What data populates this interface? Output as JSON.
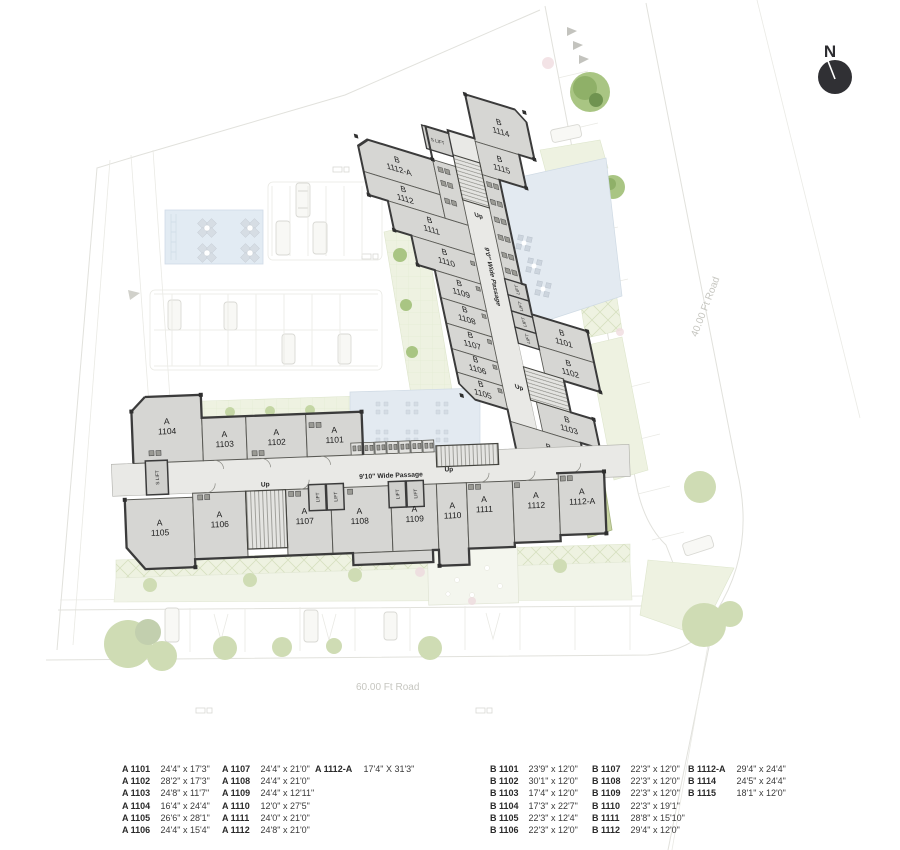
{
  "compass": {
    "label": "N"
  },
  "roads": {
    "bottom": "60.00 Ft Road",
    "right": "40.00 Ft Road"
  },
  "plan": {
    "passage_a": "9'10\" Wide Passage",
    "passage_b": "9'0\" Wide Passage",
    "up": "Up",
    "lift": "LIFT",
    "s_lift": "S LIFT",
    "a_units": [
      {
        "block": "A",
        "num": "1104"
      },
      {
        "block": "A",
        "num": "1103"
      },
      {
        "block": "A",
        "num": "1102"
      },
      {
        "block": "A",
        "num": "1101"
      },
      {
        "block": "A",
        "num": "1105"
      },
      {
        "block": "A",
        "num": "1106"
      },
      {
        "block": "A",
        "num": "1107"
      },
      {
        "block": "A",
        "num": "1108"
      },
      {
        "block": "A",
        "num": "1109"
      },
      {
        "block": "A",
        "num": "1110"
      },
      {
        "block": "A",
        "num": "1111"
      },
      {
        "block": "A",
        "num": "1112"
      },
      {
        "block": "A",
        "num": "1112-A"
      }
    ],
    "b_units": [
      {
        "block": "B",
        "num": "1112-A"
      },
      {
        "block": "B",
        "num": "1112"
      },
      {
        "block": "B",
        "num": "1111"
      },
      {
        "block": "B",
        "num": "1110"
      },
      {
        "block": "B",
        "num": "1109"
      },
      {
        "block": "B",
        "num": "1108"
      },
      {
        "block": "B",
        "num": "1107"
      },
      {
        "block": "B",
        "num": "1106"
      },
      {
        "block": "B",
        "num": "1105"
      },
      {
        "block": "B",
        "num": "1114"
      },
      {
        "block": "B",
        "num": "1115"
      },
      {
        "block": "B",
        "num": "1101"
      },
      {
        "block": "B",
        "num": "1102"
      },
      {
        "block": "B",
        "num": "1103"
      },
      {
        "block": "B",
        "num": "1104"
      }
    ]
  },
  "legend": {
    "a": [
      {
        "id": "A 1101",
        "dim": "24'4\" x 17'3\""
      },
      {
        "id": "A 1102",
        "dim": "28'2\" x 17'3\""
      },
      {
        "id": "A 1103",
        "dim": "24'8\" x 11'7\""
      },
      {
        "id": "A 1104",
        "dim": "16'4\" x 24'4\""
      },
      {
        "id": "A 1105",
        "dim": "26'6\" x 28'1\""
      },
      {
        "id": "A 1106",
        "dim": "24'4\" x 15'4\""
      },
      {
        "id": "A 1107",
        "dim": "24'4\" x 21'0\""
      },
      {
        "id": "A 1108",
        "dim": "24'4\" x 21'0\""
      },
      {
        "id": "A 1109",
        "dim": "24'4\" x 12'11\""
      },
      {
        "id": "A 1110",
        "dim": "12'0\" x 27'5\""
      },
      {
        "id": "A 1111",
        "dim": "24'0\" x 21'0\""
      },
      {
        "id": "A 1112",
        "dim": "24'8\" x 21'0\""
      },
      {
        "id": "A 1112-A",
        "dim": "17'4\" X 31'3\""
      }
    ],
    "b": [
      {
        "id": "B 1101",
        "dim": "23'9\" x 12'0\""
      },
      {
        "id": "B 1102",
        "dim": "30'1\" x 12'0\""
      },
      {
        "id": "B 1103",
        "dim": "17'4\" x 12'0\""
      },
      {
        "id": "B 1104",
        "dim": "17'3\" x 22'7\""
      },
      {
        "id": "B 1105",
        "dim": "22'3\" x 12'4\""
      },
      {
        "id": "B 1106",
        "dim": "22'3\" x 12'0\""
      },
      {
        "id": "B 1107",
        "dim": "22'3\" x 12'0\""
      },
      {
        "id": "B 1108",
        "dim": "22'3\" x 12'0\""
      },
      {
        "id": "B 1109",
        "dim": "22'3\" x 12'0\""
      },
      {
        "id": "B 1110",
        "dim": "22'3\" x 19'1\""
      },
      {
        "id": "B 1111",
        "dim": "28'8\" x 15'10\""
      },
      {
        "id": "B 1112",
        "dim": "29'4\" x 12'0\""
      },
      {
        "id": "B 1112-A",
        "dim": "29'4\" x 24'4\""
      },
      {
        "id": "B 1114",
        "dim": "24'5\" x 24'4\""
      },
      {
        "id": "B 1115",
        "dim": "18'1\" x 12'0\""
      }
    ]
  }
}
